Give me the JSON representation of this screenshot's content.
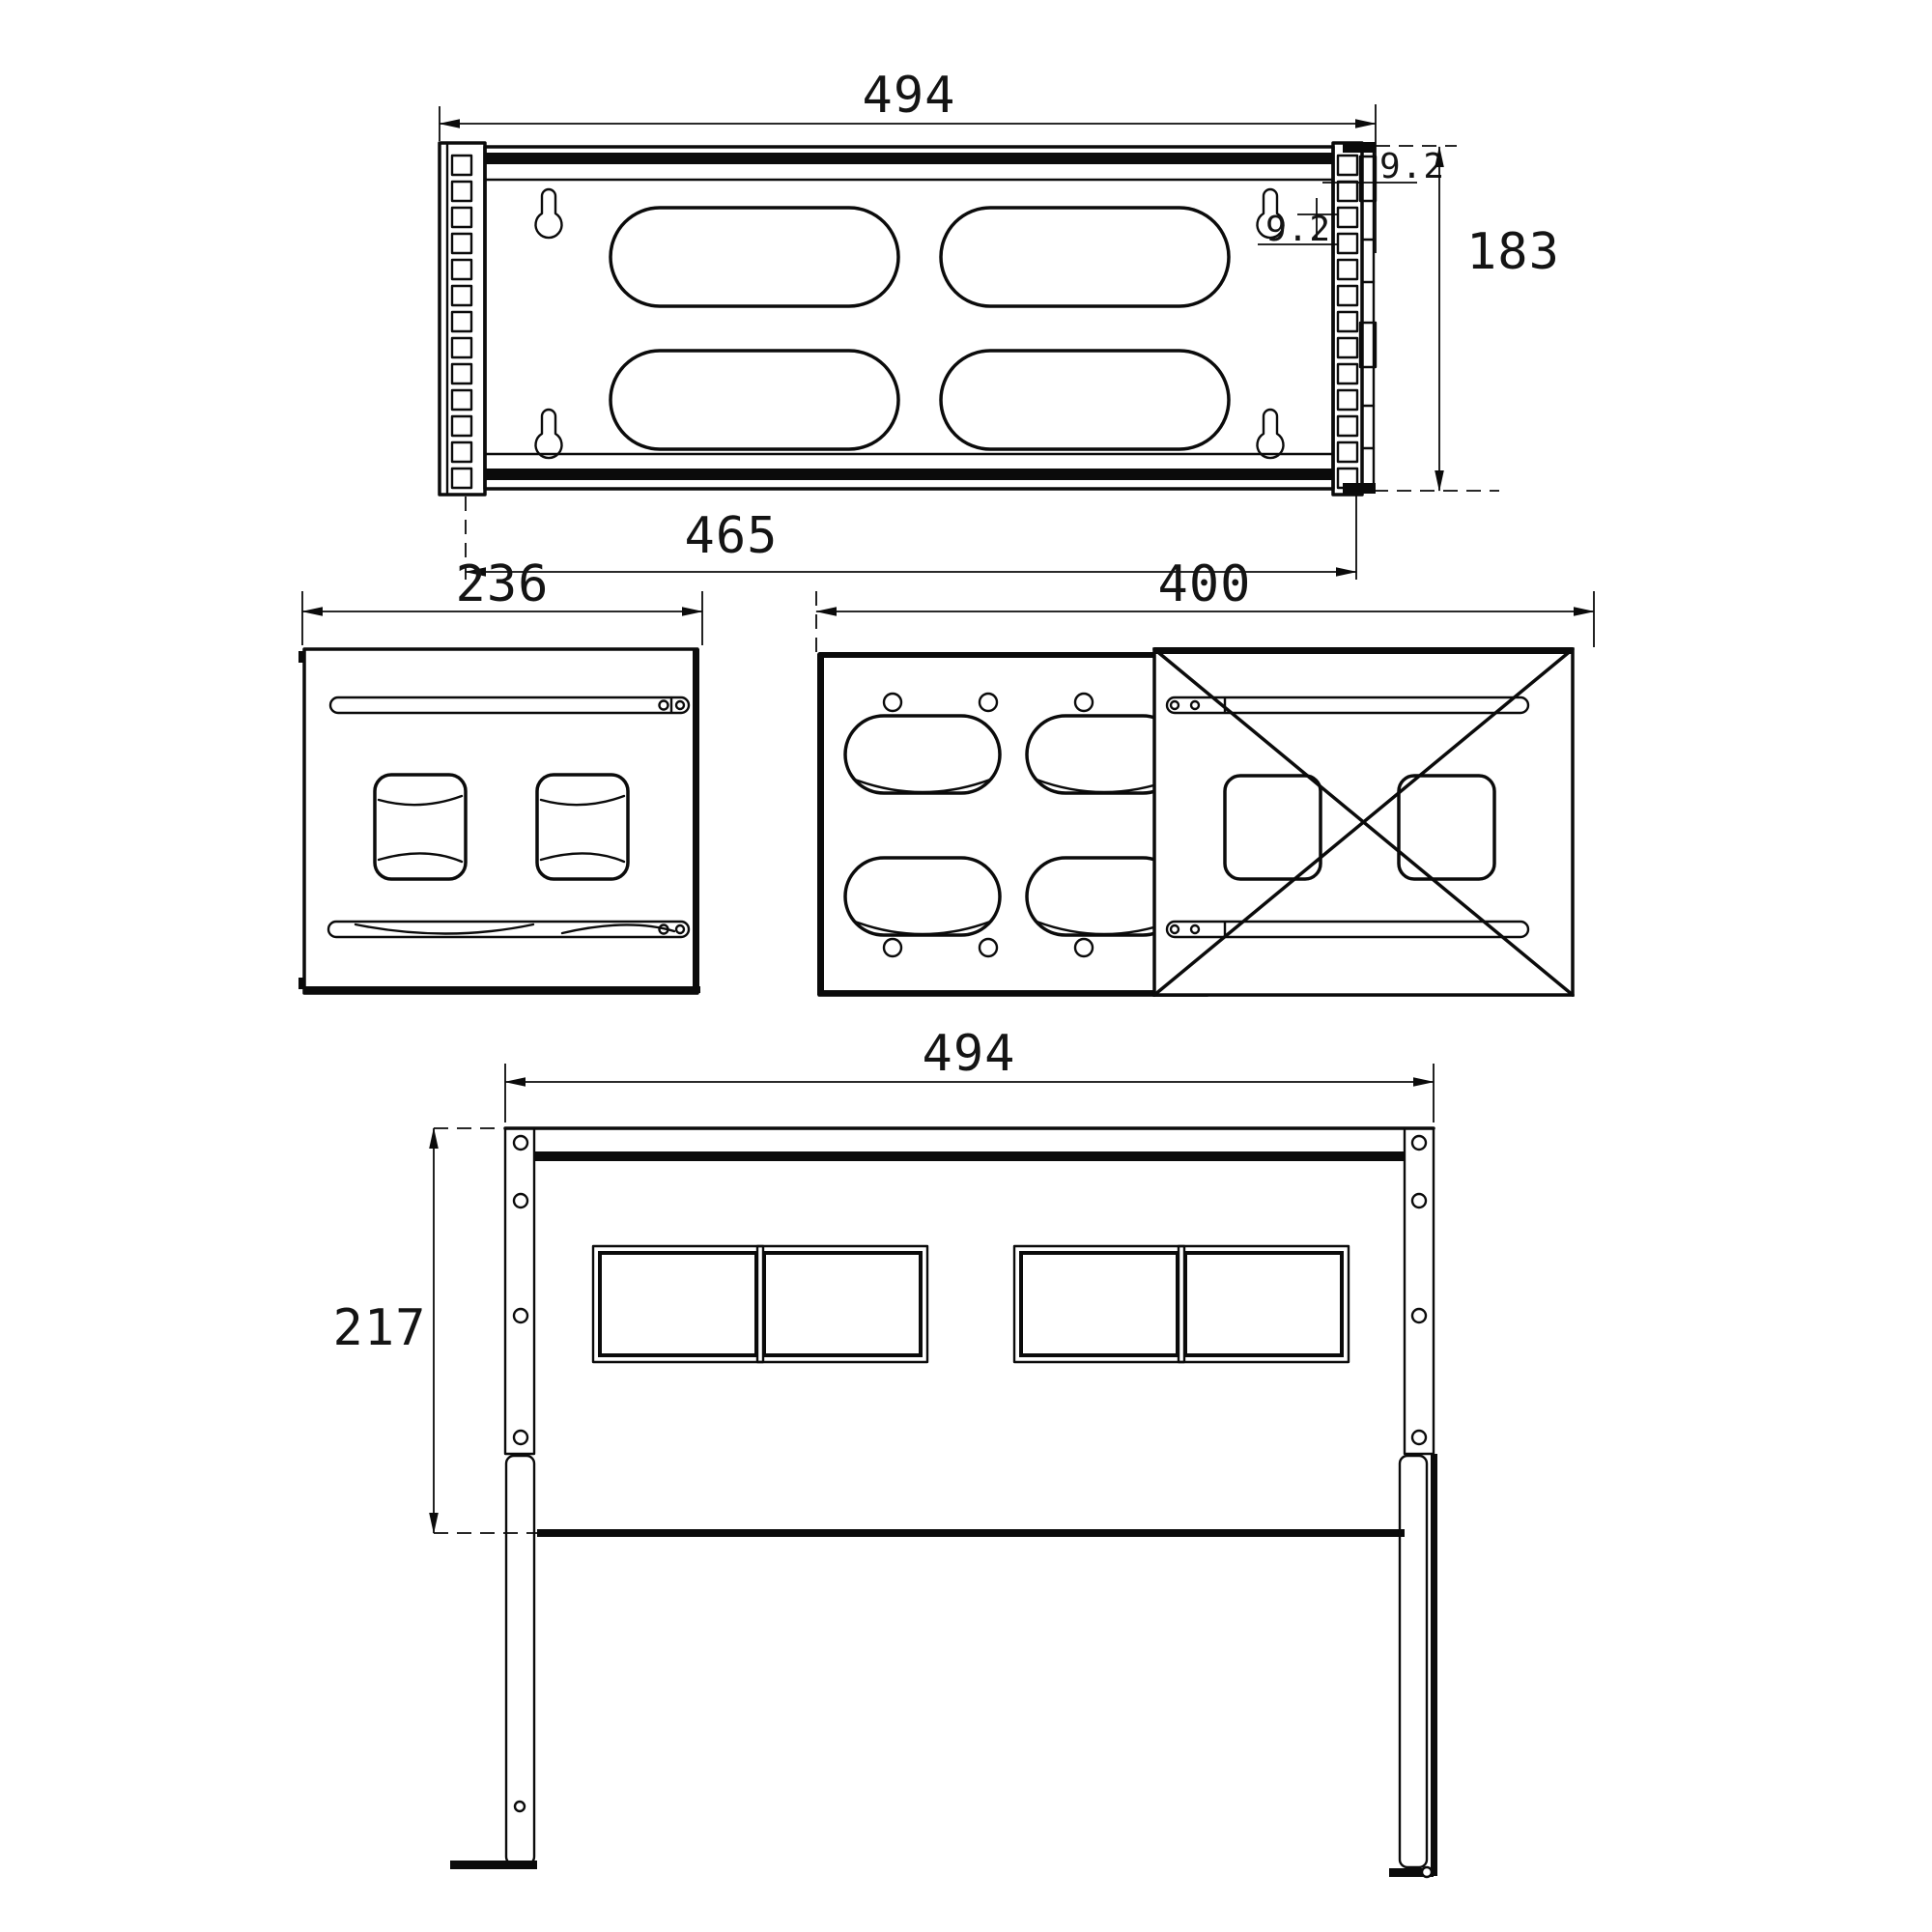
{
  "views": {
    "top": {
      "label": "top-view",
      "width": "494",
      "inner_width": "465",
      "height": "183",
      "hole_offset": "9.2",
      "hole_pitch": "9.2"
    },
    "side": {
      "label": "side-view",
      "width": "236"
    },
    "bottom": {
      "label": "bottom-panel-view",
      "depth": "400"
    },
    "front": {
      "label": "front-view",
      "width": "494",
      "height": "217"
    }
  },
  "colors": {
    "line": "#0b0b0b",
    "background": "#ffffff"
  }
}
